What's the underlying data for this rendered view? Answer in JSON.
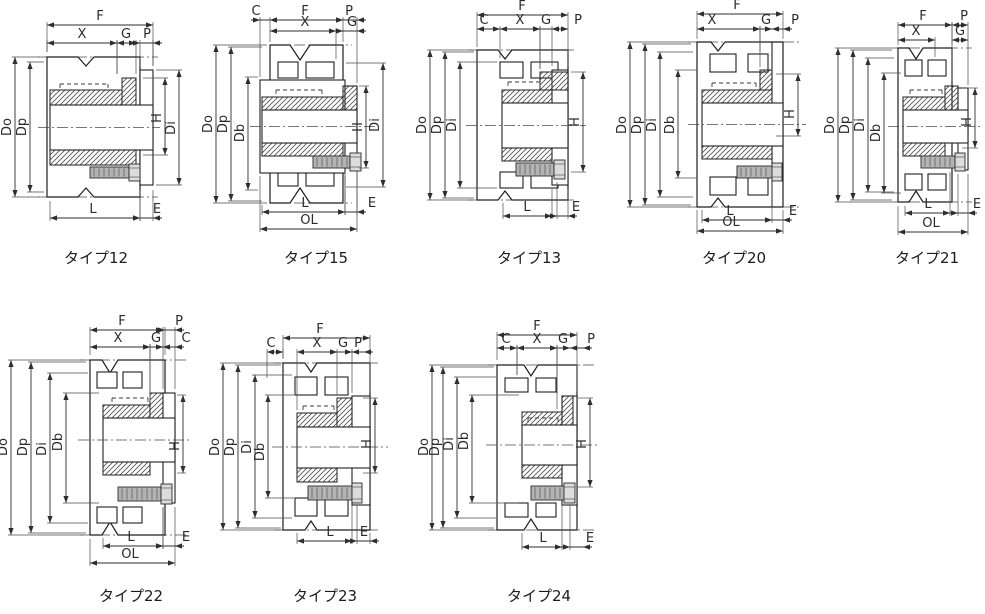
{
  "figures": [
    {
      "caption": "タイプ12",
      "dims": {
        "top": [
          "F",
          "X",
          "G",
          "P"
        ],
        "left": [
          "Do",
          "Dp"
        ],
        "right": [
          "H",
          "Di"
        ],
        "bottom": [
          "L",
          "E"
        ]
      }
    },
    {
      "caption": "タイプ15",
      "dims": {
        "top": [
          "C",
          "F",
          "P",
          "X",
          "G"
        ],
        "left": [
          "Do",
          "Dp",
          "Db"
        ],
        "right": [
          "H",
          "Di"
        ],
        "bottom": [
          "L",
          "E",
          "OL"
        ]
      }
    },
    {
      "caption": "タイプ13",
      "dims": {
        "top": [
          "F",
          "C",
          "X",
          "G",
          "P"
        ],
        "left": [
          "Do",
          "Dp",
          "Di"
        ],
        "right": [
          "H"
        ],
        "bottom": [
          "L",
          "E"
        ]
      }
    },
    {
      "caption": "タイプ20",
      "dims": {
        "top": [
          "F",
          "X",
          "G",
          "P"
        ],
        "left": [
          "Do",
          "Dp",
          "Di",
          "Db"
        ],
        "right": [
          "H"
        ],
        "bottom": [
          "L",
          "E",
          "OL"
        ]
      }
    },
    {
      "caption": "タイプ21",
      "dims": {
        "top": [
          "F",
          "P",
          "X",
          "G"
        ],
        "left": [
          "Do",
          "Dp",
          "Di",
          "Db"
        ],
        "right": [
          "H"
        ],
        "bottom": [
          "L",
          "E",
          "OL"
        ]
      }
    },
    {
      "caption": "タイプ22",
      "dims": {
        "top": [
          "F",
          "P",
          "X",
          "G",
          "C"
        ],
        "left": [
          "Do",
          "Dp",
          "Di",
          "Db"
        ],
        "right": [
          "H"
        ],
        "bottom": [
          "L",
          "E",
          "OL"
        ]
      }
    },
    {
      "caption": "タイプ23",
      "dims": {
        "top": [
          "F",
          "C",
          "X",
          "G",
          "P"
        ],
        "left": [
          "Do",
          "Dp",
          "Di",
          "Db"
        ],
        "right": [
          "H"
        ],
        "bottom": [
          "L",
          "E"
        ]
      }
    },
    {
      "caption": "タイプ24",
      "dims": {
        "top": [
          "F",
          "C",
          "X",
          "G",
          "P"
        ],
        "left": [
          "Do",
          "Dp",
          "Di",
          "Db"
        ],
        "right": [
          "H"
        ],
        "bottom": [
          "L",
          "E"
        ]
      }
    }
  ],
  "ink_color": "#1f1f1f"
}
